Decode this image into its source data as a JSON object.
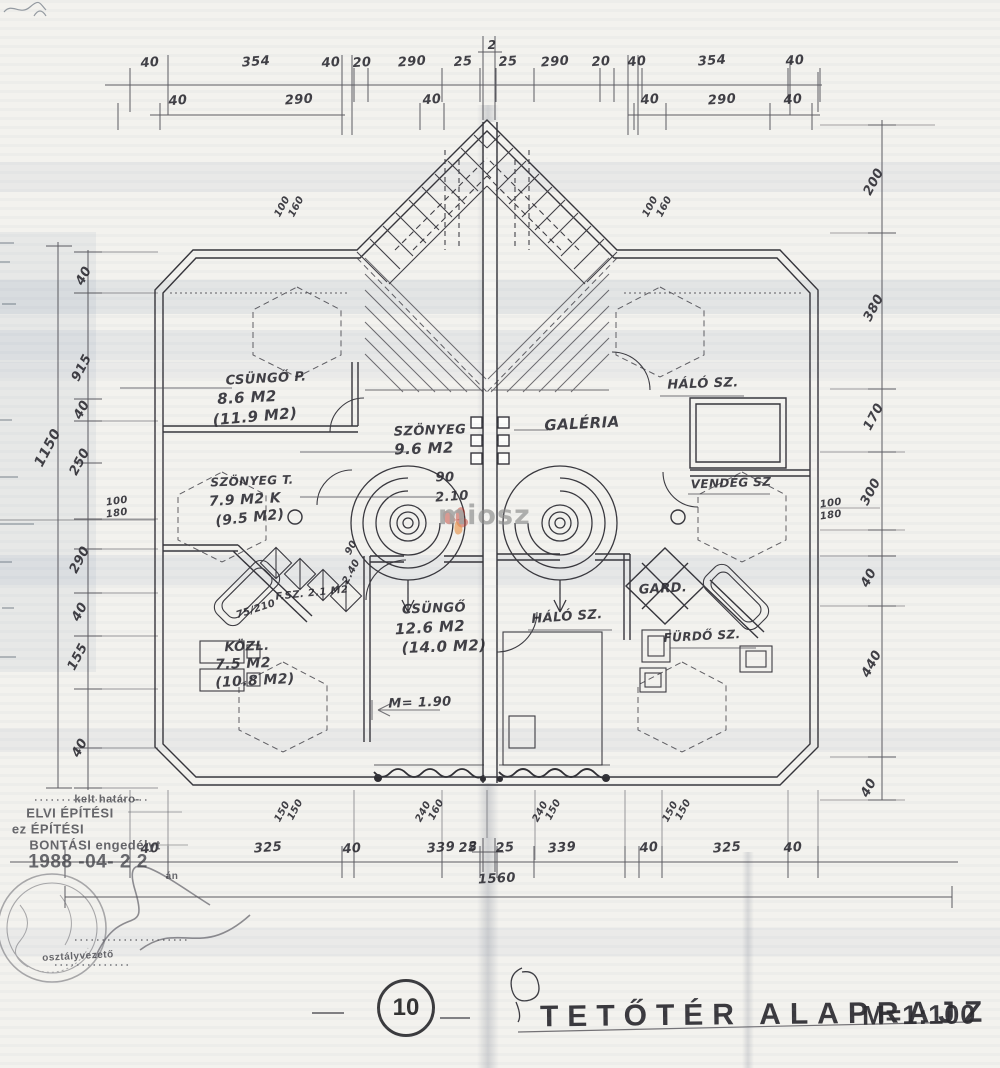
{
  "header": {
    "sheet_number": "10",
    "title": "TETŐTÉR ALAPRAJZ",
    "scale": "M=1:100"
  },
  "watermark": {
    "text": "miosz",
    "petal_color": "#c0392b",
    "leaf_color": "#e67e22"
  },
  "stamp": {
    "line_kelt": "kelt határo-",
    "line_elvi": "ELVI ÉPÍTÉSI",
    "line_ez": "ez ÉPÍTÉSI",
    "line_bontasi": "BONTÁSI engedélyt",
    "date": "1988 -04- 2 2",
    "date_suffix": "án",
    "signer": "osztályvezető"
  },
  "annotations": [
    {
      "n": "dim-top1-40a",
      "t": "40",
      "x": 150,
      "y": 63,
      "rot": -5
    },
    {
      "n": "dim-top1-354a",
      "t": "354",
      "x": 256,
      "y": 62,
      "rot": -4
    },
    {
      "n": "dim-top1-40b",
      "t": "40",
      "x": 331,
      "y": 63,
      "rot": -5
    },
    {
      "n": "dim-top1-20a",
      "t": "20",
      "x": 362,
      "y": 63,
      "rot": -4
    },
    {
      "n": "dim-top1-290a",
      "t": "290",
      "x": 412,
      "y": 62,
      "rot": -4
    },
    {
      "n": "dim-top1-25a",
      "t": "25",
      "x": 463,
      "y": 62,
      "rot": -4
    },
    {
      "n": "dim-top1-25b",
      "t": "25",
      "x": 508,
      "y": 62,
      "rot": -4
    },
    {
      "n": "dim-top1-290b",
      "t": "290",
      "x": 555,
      "y": 62,
      "rot": -4
    },
    {
      "n": "dim-top1-20b",
      "t": "20",
      "x": 601,
      "y": 62,
      "rot": -4
    },
    {
      "n": "dim-top1-40c",
      "t": "40",
      "x": 637,
      "y": 62,
      "rot": -5
    },
    {
      "n": "dim-top1-354b",
      "t": "354",
      "x": 712,
      "y": 61,
      "rot": -4
    },
    {
      "n": "dim-top1-40d",
      "t": "40",
      "x": 795,
      "y": 61,
      "rot": -5
    },
    {
      "n": "dim-top2-40a",
      "t": "40",
      "x": 178,
      "y": 101,
      "rot": -5
    },
    {
      "n": "dim-top2-290a",
      "t": "290",
      "x": 299,
      "y": 100,
      "rot": -4
    },
    {
      "n": "dim-top2-40b",
      "t": "40",
      "x": 432,
      "y": 100,
      "rot": -5
    },
    {
      "n": "dim-top2-40c",
      "t": "40",
      "x": 650,
      "y": 100,
      "rot": -5
    },
    {
      "n": "dim-top2-290b",
      "t": "290",
      "x": 722,
      "y": 100,
      "rot": -4
    },
    {
      "n": "dim-top2-40d",
      "t": "40",
      "x": 793,
      "y": 100,
      "rot": -5
    },
    {
      "n": "section-mark-top",
      "t": "2",
      "x": 492,
      "y": 45,
      "fs": 12
    },
    {
      "n": "section-mark-bottom",
      "t": "2",
      "x": 473,
      "y": 846,
      "fs": 12
    },
    {
      "n": "dim-left-1150",
      "t": "1150",
      "x": 48,
      "y": 448,
      "rot": -62,
      "fs": 14
    },
    {
      "n": "dim-left-40a",
      "t": "40",
      "x": 84,
      "y": 276,
      "rot": -62
    },
    {
      "n": "dim-left-915",
      "t": "915",
      "x": 82,
      "y": 368,
      "rot": -62
    },
    {
      "n": "dim-left-40b",
      "t": "40",
      "x": 82,
      "y": 410,
      "rot": -62
    },
    {
      "n": "dim-left-250",
      "t": "250",
      "x": 80,
      "y": 462,
      "rot": -62
    },
    {
      "n": "dim-left-100",
      "t": "100",
      "x": 117,
      "y": 502,
      "rot": -8,
      "fs": 10
    },
    {
      "n": "dim-left-180",
      "t": "180",
      "x": 117,
      "y": 514,
      "rot": -8,
      "fs": 10
    },
    {
      "n": "dim-left-290",
      "t": "290",
      "x": 80,
      "y": 560,
      "rot": -62
    },
    {
      "n": "dim-left-40c",
      "t": "40",
      "x": 80,
      "y": 612,
      "rot": -62
    },
    {
      "n": "dim-left-155",
      "t": "155",
      "x": 78,
      "y": 657,
      "rot": -62
    },
    {
      "n": "dim-left-40d",
      "t": "40",
      "x": 80,
      "y": 748,
      "rot": -62
    },
    {
      "n": "dim-right-200",
      "t": "200",
      "x": 874,
      "y": 182,
      "rot": -62
    },
    {
      "n": "dim-right-380",
      "t": "380",
      "x": 874,
      "y": 308,
      "rot": -62
    },
    {
      "n": "dim-right-170",
      "t": "170",
      "x": 874,
      "y": 417,
      "rot": -62
    },
    {
      "n": "dim-right-300",
      "t": "300",
      "x": 871,
      "y": 492,
      "rot": -62
    },
    {
      "n": "dim-right-40a",
      "t": "40",
      "x": 869,
      "y": 578,
      "rot": -62
    },
    {
      "n": "dim-right-440",
      "t": "440",
      "x": 872,
      "y": 664,
      "rot": -62
    },
    {
      "n": "dim-right-40b",
      "t": "40",
      "x": 869,
      "y": 788,
      "rot": -62
    },
    {
      "n": "dim-right-100",
      "t": "100",
      "x": 831,
      "y": 504,
      "rot": -8,
      "fs": 10
    },
    {
      "n": "dim-right-180",
      "t": "180",
      "x": 831,
      "y": 516,
      "rot": -8,
      "fs": 10
    },
    {
      "n": "window-top-left-100",
      "t": "100",
      "x": 283,
      "y": 207,
      "rot": -62,
      "fs": 10
    },
    {
      "n": "window-top-left-160",
      "t": "160",
      "x": 297,
      "y": 207,
      "rot": -62,
      "fs": 10
    },
    {
      "n": "window-top-right-100",
      "t": "100",
      "x": 651,
      "y": 207,
      "rot": -62,
      "fs": 10
    },
    {
      "n": "window-top-right-160",
      "t": "160",
      "x": 665,
      "y": 207,
      "rot": -62,
      "fs": 10
    },
    {
      "n": "dim-bottom-40a",
      "t": "40",
      "x": 150,
      "y": 849,
      "rot": -5
    },
    {
      "n": "dim-bottom-325a",
      "t": "325",
      "x": 268,
      "y": 848,
      "rot": -4
    },
    {
      "n": "dim-bottom-40b",
      "t": "40",
      "x": 352,
      "y": 849,
      "rot": -5
    },
    {
      "n": "dim-bottom-339a",
      "t": "339",
      "x": 441,
      "y": 848,
      "rot": -4
    },
    {
      "n": "dim-bottom-25a",
      "t": "25",
      "x": 468,
      "y": 848,
      "rot": -4
    },
    {
      "n": "dim-bottom-25b",
      "t": "25",
      "x": 505,
      "y": 848,
      "rot": -4
    },
    {
      "n": "dim-bottom-339b",
      "t": "339",
      "x": 562,
      "y": 848,
      "rot": -4
    },
    {
      "n": "dim-bottom-40c",
      "t": "40",
      "x": 649,
      "y": 848,
      "rot": -5
    },
    {
      "n": "dim-bottom-325b",
      "t": "325",
      "x": 727,
      "y": 848,
      "rot": -4
    },
    {
      "n": "dim-bottom-40d",
      "t": "40",
      "x": 793,
      "y": 848,
      "rot": -5
    },
    {
      "n": "dim-bottom-1560",
      "t": "1560",
      "x": 497,
      "y": 879,
      "rot": -3
    },
    {
      "n": "window-bottom-150a",
      "t": "150",
      "x": 283,
      "y": 812,
      "rot": -62,
      "fs": 10
    },
    {
      "n": "window-bottom-150b",
      "t": "150",
      "x": 296,
      "y": 810,
      "rot": -62,
      "fs": 10
    },
    {
      "n": "window-bottom-240a",
      "t": "240",
      "x": 424,
      "y": 812,
      "rot": -62,
      "fs": 10
    },
    {
      "n": "window-bottom-160a",
      "t": "160",
      "x": 437,
      "y": 810,
      "rot": -62,
      "fs": 10
    },
    {
      "n": "window-bottom-240b",
      "t": "240",
      "x": 541,
      "y": 812,
      "rot": -62,
      "fs": 10
    },
    {
      "n": "window-bottom-150c",
      "t": "150",
      "x": 554,
      "y": 810,
      "rot": -62,
      "fs": 10
    },
    {
      "n": "window-bottom-150d",
      "t": "150",
      "x": 671,
      "y": 812,
      "rot": -62,
      "fs": 10
    },
    {
      "n": "window-bottom-150e",
      "t": "150",
      "x": 684,
      "y": 810,
      "rot": -62,
      "fs": 10
    },
    {
      "n": "room-label-csungo-p",
      "t": "CSÜNGŐ P.",
      "x": 266,
      "y": 379,
      "rot": -3
    },
    {
      "n": "room-area-csungo-p",
      "t": "8.6 M2",
      "x": 247,
      "y": 398,
      "rot": -3,
      "fs": 15
    },
    {
      "n": "room-area2-csungo-p",
      "t": "(11.9 M2)",
      "x": 255,
      "y": 417,
      "rot": -5,
      "fs": 15
    },
    {
      "n": "room-label-szonyeg",
      "t": "SZÖNYEG",
      "x": 430,
      "y": 431,
      "rot": -2
    },
    {
      "n": "room-area-szonyeg",
      "t": "9.6 M2",
      "x": 424,
      "y": 449,
      "rot": -2,
      "fs": 15
    },
    {
      "n": "room-label-szonyeg-t",
      "t": "SZÖNYEG T.",
      "x": 252,
      "y": 481,
      "rot": -2,
      "fs": 12
    },
    {
      "n": "room-area-szonyeg-t",
      "t": "7.9 M2 K",
      "x": 245,
      "y": 500,
      "rot": -3,
      "fs": 14
    },
    {
      "n": "room-area2-szonyeg-t",
      "t": "(9.5 M2)",
      "x": 250,
      "y": 518,
      "rot": -6,
      "fs": 14
    },
    {
      "n": "door-note-90",
      "t": "90",
      "x": 445,
      "y": 478
    },
    {
      "n": "door-note-210",
      "t": "2.10",
      "x": 452,
      "y": 497,
      "rot": -4
    },
    {
      "n": "door-note-90b",
      "t": "90",
      "x": 352,
      "y": 548,
      "rot": -62,
      "fs": 10
    },
    {
      "n": "door-note-240b",
      "t": "2.40",
      "x": 352,
      "y": 572,
      "rot": -62,
      "fs": 10
    },
    {
      "n": "room-label-csungo2",
      "t": "CSÜNGŐ",
      "x": 434,
      "y": 609,
      "rot": -2
    },
    {
      "n": "room-area-csungo2",
      "t": "12.6 M2",
      "x": 430,
      "y": 628,
      "rot": -3,
      "fs": 15
    },
    {
      "n": "room-area2-csungo2",
      "t": "(14.0 M2)",
      "x": 444,
      "y": 647,
      "rot": -2,
      "fs": 15
    },
    {
      "n": "room-label-fsz",
      "t": "F.SZ. 2.1 M2",
      "x": 312,
      "y": 594,
      "rot": -6,
      "fs": 10
    },
    {
      "n": "door-note-75-210",
      "t": "75/210",
      "x": 256,
      "y": 610,
      "rot": -18,
      "fs": 10
    },
    {
      "n": "room-label-kozl",
      "t": "KÖZL.",
      "x": 247,
      "y": 647,
      "rot": -2
    },
    {
      "n": "room-area-kozl",
      "t": "7.5 M2",
      "x": 243,
      "y": 664,
      "rot": -2,
      "fs": 14
    },
    {
      "n": "room-area2-kozl",
      "t": "(10.8 M2)",
      "x": 255,
      "y": 681,
      "rot": -3,
      "fs": 14
    },
    {
      "n": "headroom-note",
      "t": "M= 1.90",
      "x": 420,
      "y": 703,
      "rot": -2
    },
    {
      "n": "room-label-halo-top",
      "t": "HÁLÓ SZ.",
      "x": 703,
      "y": 384,
      "rot": -2
    },
    {
      "n": "room-label-galeria",
      "t": "GALÉRIA",
      "x": 582,
      "y": 424,
      "rot": -3,
      "fs": 15
    },
    {
      "n": "room-label-vendeg",
      "t": "VENDÉG SZ",
      "x": 731,
      "y": 483,
      "rot": -2,
      "fs": 12
    },
    {
      "n": "room-label-gard",
      "t": "GARD.",
      "x": 663,
      "y": 589,
      "rot": -3
    },
    {
      "n": "room-label-halo-mid",
      "t": "HÁLÓ SZ.",
      "x": 567,
      "y": 617,
      "rot": -4
    },
    {
      "n": "room-label-furdo",
      "t": "FÜRDŐ SZ.",
      "x": 702,
      "y": 636,
      "rot": -3,
      "fs": 12
    },
    {
      "n": "stamp-kelt",
      "t": "kelt határo-",
      "x": 107,
      "y": 800,
      "cls": "stamp",
      "fs": 11
    },
    {
      "n": "stamp-elvi",
      "t": "ELVI ÉPÍTÉSI",
      "x": 70,
      "y": 813,
      "cls": "stamp",
      "fs": 13
    },
    {
      "n": "stamp-ez",
      "t": "ez ÉPÍTÉSI",
      "x": 48,
      "y": 829,
      "cls": "stamp",
      "fs": 13
    },
    {
      "n": "stamp-bontasi",
      "t": "BONTÁSI engedélyt",
      "x": 95,
      "y": 845,
      "cls": "stamp",
      "fs": 13
    },
    {
      "n": "stamp-date",
      "t": "1988 -04- 2 2",
      "x": 88,
      "y": 862,
      "cls": "stamp",
      "fs": 19
    },
    {
      "n": "stamp-date-suffix",
      "t": "án",
      "x": 172,
      "y": 877,
      "cls": "stamp",
      "fs": 10
    },
    {
      "n": "stamp-signer",
      "t": "osztályvezető",
      "x": 78,
      "y": 957,
      "cls": "stamp",
      "fs": 10,
      "rot": -3
    }
  ]
}
